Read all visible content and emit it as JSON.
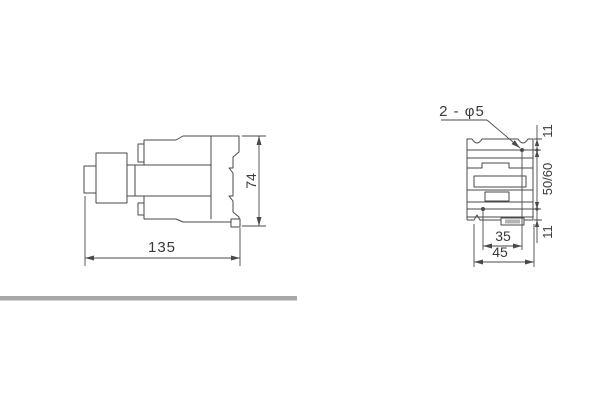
{
  "drawing": {
    "kind": "technical-dimension-drawing",
    "side_view": {
      "width_label": "135",
      "height_label": "74"
    },
    "front_view": {
      "hole_callout": "2 - φ5",
      "top_margin_label": "11",
      "vertical_pitch_label": "50/60",
      "bottom_margin_label": "11",
      "hole_pitch_label": "35",
      "width_label": "45"
    },
    "colors": {
      "line": "#4a4a4a",
      "text": "#3a3a3a",
      "divider": "#a8a8a8",
      "background": "#ffffff"
    }
  }
}
